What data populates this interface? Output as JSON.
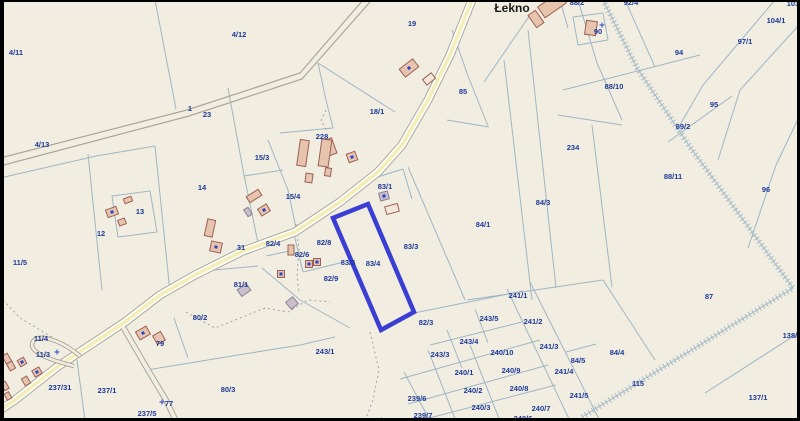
{
  "map": {
    "title": "Cadastral parcel map",
    "place_label": "Łekno",
    "highlighted_parcel": "83/4",
    "colors": {
      "background": "#f2ede1",
      "parcel_line": "#9db6c4",
      "label": "#1d3a99",
      "road_yellow": "#f4eeb6",
      "road_casing": "#aaa89c",
      "highlight": "#3a3ed2",
      "building_fill": "#e6c4ae",
      "building_stroke": "#9b6055",
      "building_gray": "#c9c0cb",
      "marker": "#2a43c8",
      "frame": "#000000"
    },
    "parcel_labels": [
      {
        "t": "4/11",
        "x": 16,
        "y": 52
      },
      {
        "t": "4/12",
        "x": 239,
        "y": 34
      },
      {
        "t": "4/13",
        "x": 42,
        "y": 144
      },
      {
        "t": "1",
        "x": 190,
        "y": 108
      },
      {
        "t": "23",
        "x": 207,
        "y": 114
      },
      {
        "t": "19",
        "x": 412,
        "y": 23
      },
      {
        "t": "15/3",
        "x": 262,
        "y": 157
      },
      {
        "t": "14",
        "x": 202,
        "y": 187
      },
      {
        "t": "15/4",
        "x": 293,
        "y": 196
      },
      {
        "t": "13",
        "x": 140,
        "y": 211
      },
      {
        "t": "12",
        "x": 101,
        "y": 233
      },
      {
        "t": "11/5",
        "x": 20,
        "y": 262
      },
      {
        "t": "228",
        "x": 322,
        "y": 136
      },
      {
        "t": "18/1",
        "x": 377,
        "y": 111
      },
      {
        "t": "85",
        "x": 463,
        "y": 91
      },
      {
        "t": "31",
        "x": 241,
        "y": 247
      },
      {
        "t": "82/4",
        "x": 273,
        "y": 243
      },
      {
        "t": "82/8",
        "x": 324,
        "y": 242
      },
      {
        "t": "82/6",
        "x": 302,
        "y": 254
      },
      {
        "t": "82/9",
        "x": 331,
        "y": 278
      },
      {
        "t": "83/1",
        "x": 385,
        "y": 186
      },
      {
        "t": "83/3",
        "x": 411,
        "y": 246
      },
      {
        "t": "83/4",
        "x": 373,
        "y": 263
      },
      {
        "t": "83/5",
        "x": 348,
        "y": 262
      },
      {
        "t": "84/1",
        "x": 483,
        "y": 224
      },
      {
        "t": "84/3",
        "x": 543,
        "y": 202
      },
      {
        "t": "234",
        "x": 573,
        "y": 147
      },
      {
        "t": "88/11",
        "x": 673,
        "y": 176
      },
      {
        "t": "96",
        "x": 766,
        "y": 189
      },
      {
        "t": "88/10",
        "x": 614,
        "y": 86
      },
      {
        "t": "94",
        "x": 679,
        "y": 52
      },
      {
        "t": "95",
        "x": 714,
        "y": 104
      },
      {
        "t": "89/2",
        "x": 683,
        "y": 126
      },
      {
        "t": "97/1",
        "x": 745,
        "y": 41
      },
      {
        "t": "104/1",
        "x": 776,
        "y": 20
      },
      {
        "t": "103",
        "x": 793,
        "y": 3
      },
      {
        "t": "88/2",
        "x": 577,
        "y": 2
      },
      {
        "t": "92/4",
        "x": 631,
        "y": 2
      },
      {
        "t": "90",
        "x": 598,
        "y": 31
      },
      {
        "t": "87",
        "x": 709,
        "y": 296
      },
      {
        "t": "138/1",
        "x": 792,
        "y": 335
      },
      {
        "t": "137/1",
        "x": 758,
        "y": 397
      },
      {
        "t": "115",
        "x": 638,
        "y": 383
      },
      {
        "t": "84/4",
        "x": 617,
        "y": 352
      },
      {
        "t": "84/5",
        "x": 578,
        "y": 360
      },
      {
        "t": "241/1",
        "x": 518,
        "y": 295
      },
      {
        "t": "241/2",
        "x": 533,
        "y": 321
      },
      {
        "t": "241/3",
        "x": 549,
        "y": 346
      },
      {
        "t": "241/4",
        "x": 564,
        "y": 371
      },
      {
        "t": "241/5",
        "x": 579,
        "y": 395
      },
      {
        "t": "243/5",
        "x": 489,
        "y": 318
      },
      {
        "t": "243/4",
        "x": 469,
        "y": 341
      },
      {
        "t": "243/3",
        "x": 440,
        "y": 354
      },
      {
        "t": "240/10",
        "x": 502,
        "y": 352
      },
      {
        "t": "240/1",
        "x": 464,
        "y": 372
      },
      {
        "t": "240/9",
        "x": 511,
        "y": 370
      },
      {
        "t": "240/2",
        "x": 473,
        "y": 390
      },
      {
        "t": "240/8",
        "x": 519,
        "y": 388
      },
      {
        "t": "240/3",
        "x": 481,
        "y": 407
      },
      {
        "t": "240/7",
        "x": 541,
        "y": 408
      },
      {
        "t": "240/6",
        "x": 523,
        "y": 418
      },
      {
        "t": "239/6",
        "x": 417,
        "y": 398
      },
      {
        "t": "239/7",
        "x": 423,
        "y": 415
      },
      {
        "t": "239/1",
        "x": 377,
        "y": 420
      },
      {
        "t": "243/1",
        "x": 325,
        "y": 351
      },
      {
        "t": "82/3",
        "x": 426,
        "y": 322
      },
      {
        "t": "80/2",
        "x": 200,
        "y": 317
      },
      {
        "t": "80/3",
        "x": 228,
        "y": 389
      },
      {
        "t": "81/1",
        "x": 241,
        "y": 284
      },
      {
        "t": "79",
        "x": 160,
        "y": 343
      },
      {
        "t": "77",
        "x": 169,
        "y": 403
      },
      {
        "t": "237/5",
        "x": 147,
        "y": 413
      },
      {
        "t": "237/1",
        "x": 107,
        "y": 390
      },
      {
        "t": "237/31",
        "x": 60,
        "y": 387
      },
      {
        "t": "11/4",
        "x": 41,
        "y": 338
      },
      {
        "t": "11/3",
        "x": 43,
        "y": 354
      }
    ],
    "buildings": [
      [
        552,
        5,
        26,
        13,
        -35,
        "o",
        0
      ],
      [
        536,
        19,
        9,
        15,
        -35,
        "o",
        0
      ],
      [
        591,
        28,
        11,
        14,
        8,
        "o",
        0
      ],
      [
        409,
        68,
        17,
        10,
        -38,
        "o",
        1
      ],
      [
        429,
        79,
        11,
        7,
        -38,
        "l",
        0
      ],
      [
        330,
        147,
        9,
        16,
        -20,
        "o",
        0
      ],
      [
        352,
        157,
        9,
        9,
        -20,
        "o",
        1
      ],
      [
        303,
        153,
        9,
        26,
        8,
        "o",
        0
      ],
      [
        325,
        153,
        10,
        27,
        8,
        "o",
        0
      ],
      [
        309,
        178,
        7,
        9,
        8,
        "o",
        0
      ],
      [
        328,
        172,
        6,
        8,
        8,
        "o",
        0
      ],
      [
        254,
        196,
        14,
        7,
        -32,
        "o",
        0
      ],
      [
        264,
        210,
        10,
        8,
        -32,
        "o",
        1
      ],
      [
        248,
        212,
        5,
        8,
        -32,
        "g",
        0
      ],
      [
        112,
        212,
        11,
        8,
        -20,
        "o",
        1
      ],
      [
        128,
        200,
        8,
        5,
        -20,
        "o",
        0
      ],
      [
        122,
        222,
        7,
        6,
        -20,
        "o",
        0
      ],
      [
        210,
        228,
        8,
        17,
        12,
        "o",
        0
      ],
      [
        216,
        247,
        11,
        10,
        12,
        "o",
        1
      ],
      [
        291,
        250,
        6,
        10,
        0,
        "o",
        0
      ],
      [
        309,
        264,
        7,
        7,
        0,
        "o",
        1
      ],
      [
        317,
        262,
        7,
        7,
        0,
        "o",
        1
      ],
      [
        281,
        274,
        7,
        7,
        0,
        "o",
        1
      ],
      [
        384,
        196,
        9,
        8,
        -15,
        "g",
        1
      ],
      [
        392,
        209,
        13,
        8,
        -15,
        "l",
        0
      ],
      [
        244,
        290,
        11,
        8,
        -35,
        "g",
        0
      ],
      [
        143,
        333,
        12,
        9,
        -30,
        "o",
        1
      ],
      [
        159,
        338,
        9,
        10,
        -30,
        "o",
        0
      ],
      [
        7,
        359,
        6,
        10,
        -30,
        "o",
        0
      ],
      [
        11,
        366,
        6,
        8,
        -30,
        "o",
        0
      ],
      [
        22,
        362,
        7,
        7,
        -30,
        "o",
        1
      ],
      [
        37,
        372,
        8,
        7,
        -30,
        "o",
        1
      ],
      [
        26,
        381,
        6,
        8,
        -30,
        "o",
        0
      ],
      [
        5,
        386,
        5,
        8,
        -30,
        "o",
        0
      ],
      [
        8,
        396,
        5,
        7,
        -30,
        "o",
        0
      ],
      [
        292,
        303,
        9,
        9,
        -40,
        "g",
        0
      ]
    ],
    "markers": [
      [
        602,
        25
      ],
      [
        162,
        402
      ],
      [
        57,
        352
      ]
    ]
  }
}
